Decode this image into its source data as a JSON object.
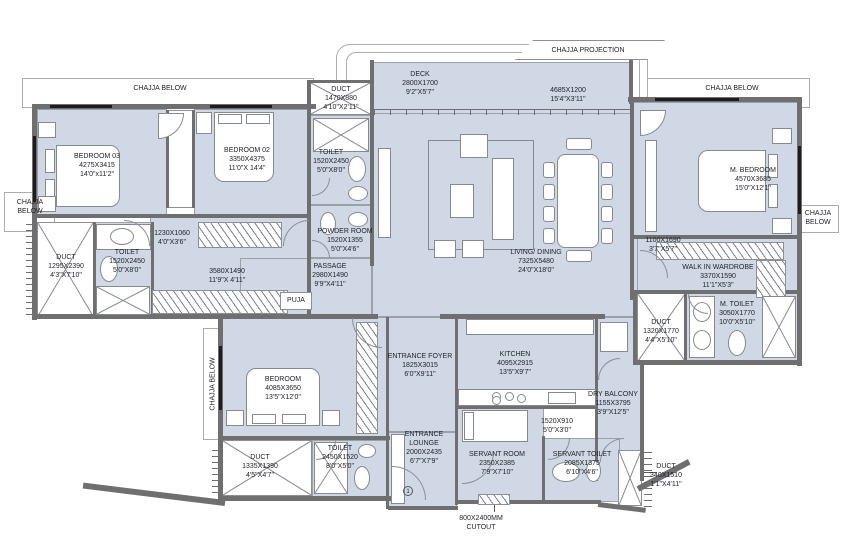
{
  "colors": {
    "room_fill": "#cfd8e4",
    "wall": "#6f6f6f",
    "background": "#ffffff",
    "line": "#8b9096",
    "text": "#22242a"
  },
  "annotations": {
    "chajja_projection": "CHAJJA PROJECTION",
    "chajja_below": "CHAJJA BELOW",
    "chajja_line1": "CHAJJA",
    "chajja_line2": "BELOW",
    "cutout_line1": "800X2400MM",
    "cutout_line2": "CUTOUT",
    "entrance_marker": "1",
    "puja": "PUJA"
  },
  "rooms": [
    {
      "name": "DECK",
      "metric": "2800X1700",
      "imperial": "9'2\"X5'7\""
    },
    {
      "name": "",
      "metric": "4685X1200",
      "imperial": "15'4\"X3'11\""
    },
    {
      "name": "DUCT",
      "metric": "1470X880",
      "imperial": "4'10\"X2'11\""
    },
    {
      "name": "BEDROOM 03",
      "metric": "4275X3415",
      "imperial": "14'0\"x11'2\""
    },
    {
      "name": "BEDROOM 02",
      "metric": "3350X4375",
      "imperial": "11'0\"X 14'4\""
    },
    {
      "name": "M. BEDROOM",
      "metric": "4570X3685",
      "imperial": "15'0\"X12'1\""
    },
    {
      "name": "TOILET",
      "metric": "1520X2450",
      "imperial": "5'0\"X8'0\""
    },
    {
      "name": "",
      "metric": "1230X1060",
      "imperial": "4'0\"X3'6\""
    },
    {
      "name": "DUCT",
      "metric": "1295X2390",
      "imperial": "4'3\"X7'10\""
    },
    {
      "name": "TOILET",
      "metric": "1520X2450",
      "imperial": "5'0\"X8'0\""
    },
    {
      "name": "POWDER ROOM",
      "metric": "1520X1355",
      "imperial": "5'0\"X4'6\""
    },
    {
      "name": "",
      "metric": "3580X1490",
      "imperial": "11'9\"X 4'11\""
    },
    {
      "name": "PASSAGE",
      "metric": "2980X1490",
      "imperial": "9'9\"X4'11\""
    },
    {
      "name": "LIVING/ DINING",
      "metric": "7325X5480",
      "imperial": "24'0\"X18'0\""
    },
    {
      "name": "",
      "metric": "1100X1690",
      "imperial": "3'7\"X5'7\""
    },
    {
      "name": "WALK IN WARDROBE",
      "metric": "3370X1590",
      "imperial": "11'1\"X5'3\""
    },
    {
      "name": "M. TOILET",
      "metric": "3050X1770",
      "imperial": "10'0\"X5'10\""
    },
    {
      "name": "DUCT",
      "metric": "1320X1770",
      "imperial": "4'4\"X5'10\""
    },
    {
      "name": "BEDROOM",
      "metric": "4085X3650",
      "imperial": "13'5\"X12'0\""
    },
    {
      "name": "ENTRANCE FOYER",
      "metric": "1825X3015",
      "imperial": "6'0\"X9'11\""
    },
    {
      "name": "KITCHEN",
      "metric": "4095X2915",
      "imperial": "13'5\"X9'7\""
    },
    {
      "name": "DRY BALCONY",
      "metric": "1155X3795",
      "imperial": "3'9\"X12'5\""
    },
    {
      "name": "",
      "metric": "1520X910",
      "imperial": "5'0\"X3'0\""
    },
    {
      "name": "DUCT",
      "metric": "1335X1390",
      "imperial": "4'5\"X4'7\""
    },
    {
      "name": "TOILET",
      "metric": "2450X1520",
      "imperial": "8'0\"X5'0\""
    },
    {
      "name": "ENTRANCE",
      "name2": "LOUNGE",
      "metric": "2000X2435",
      "imperial": "6'7\"X7'9\""
    },
    {
      "name": "SERVANT ROOM",
      "metric": "2350X2385",
      "imperial": "7'9\"X7'10\""
    },
    {
      "name": "SERVANT TOILET",
      "metric": "2085X1375",
      "imperial": "6'10\"X4'6\""
    },
    {
      "name": "DUCT",
      "metric": "340X1510",
      "imperial": "1'1\"X4'11\""
    }
  ]
}
